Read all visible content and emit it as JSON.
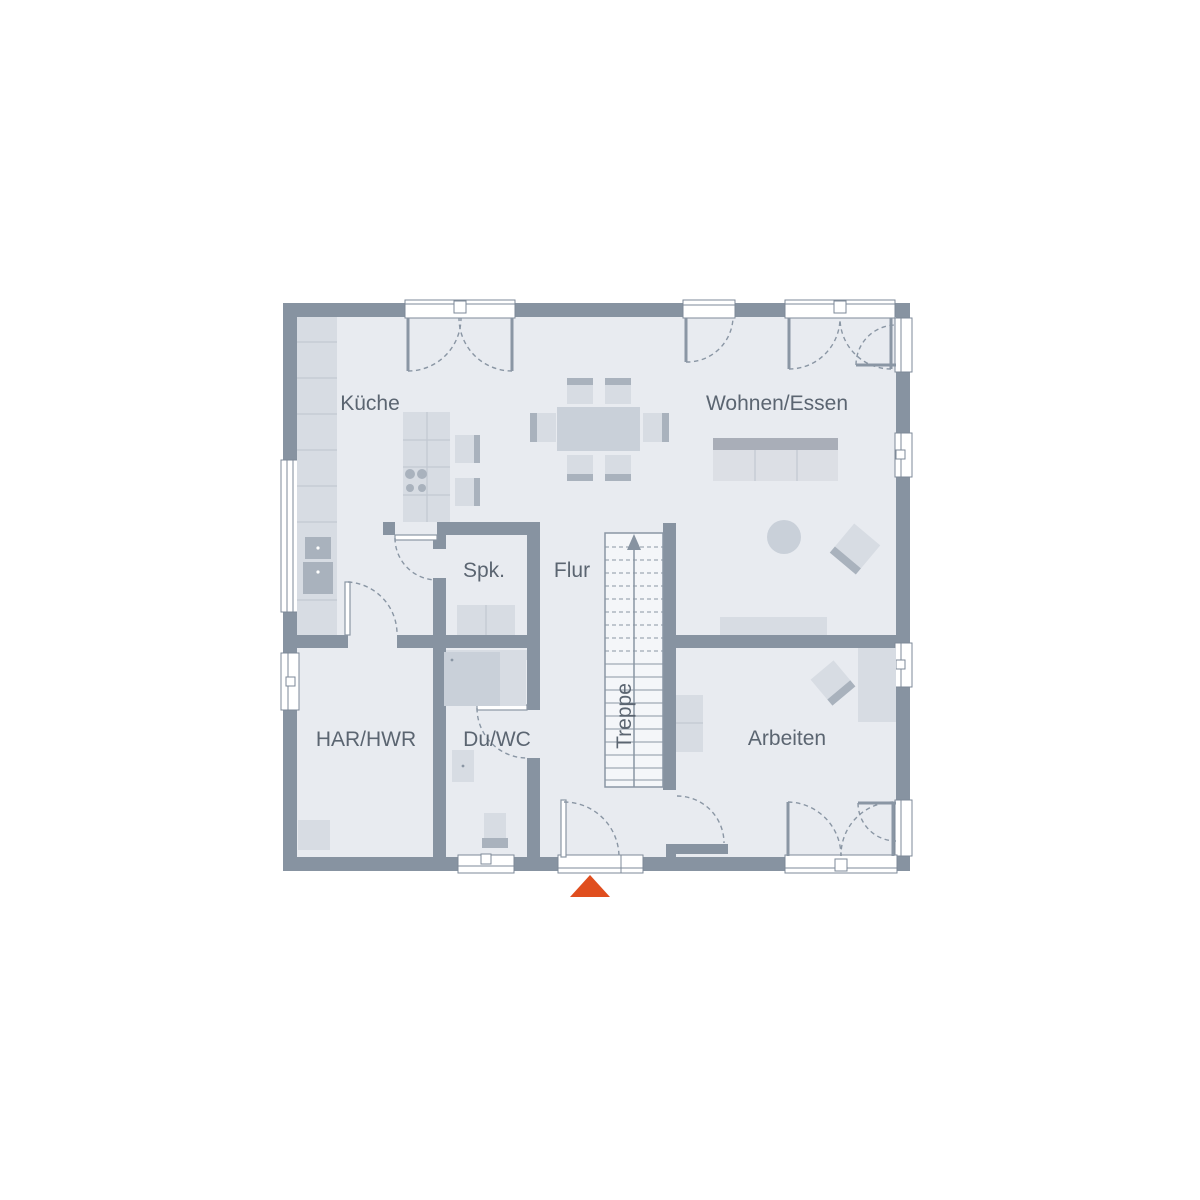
{
  "rooms": {
    "kueche": {
      "label": "Küche"
    },
    "wohnen_essen": {
      "label": "Wohnen/Essen"
    },
    "spk": {
      "label": "Spk."
    },
    "flur": {
      "label": "Flur"
    },
    "treppe": {
      "label": "Treppe"
    },
    "har_hwr": {
      "label": "HAR/HWR"
    },
    "du_wc": {
      "label": "Du/WC"
    },
    "arbeiten": {
      "label": "Arbeiten"
    }
  },
  "colors": {
    "background": "#ffffff",
    "wall": "#8793a1",
    "floor": "#e8ebf0",
    "stairFloor": "#f4f6f9",
    "furnitureLight": "#d7dce3",
    "furnitureMid": "#c9d0d9",
    "furnitureDark": "#a9b2bd",
    "sofaSeat": "#dcdfe5",
    "sofaBack": "#a9aeb8",
    "lineFrame": "#7e8a98",
    "doorArc": "#8a96a4",
    "cabinetLine": "#c2c8d1",
    "text": "#5b6571",
    "entranceMarker": "#e04e1e"
  },
  "markers": {
    "entrance_triangle": "entrance-direction-marker"
  }
}
